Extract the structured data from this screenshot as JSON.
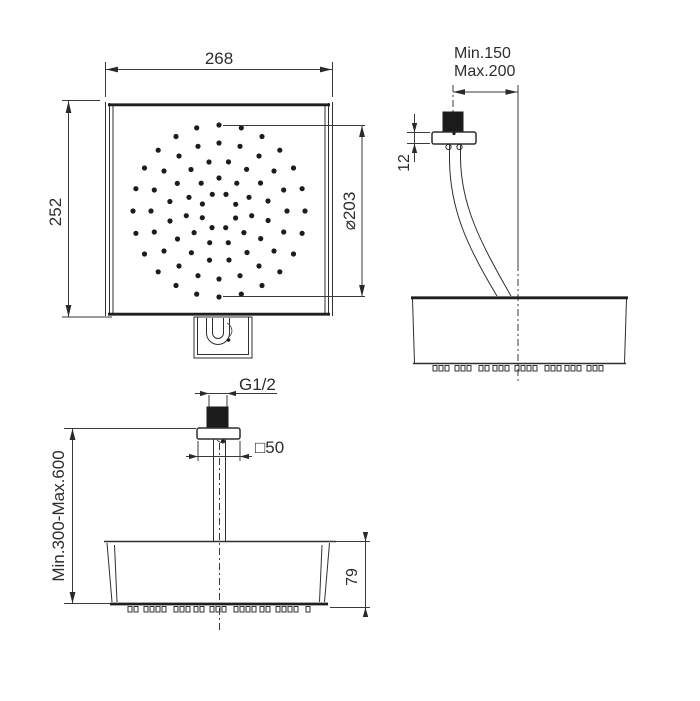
{
  "drawing": {
    "type": "technical-dimension-drawing",
    "subject": "square rain shower head, wall-arm and ceiling-arm installation views",
    "line_color": "#2f2f2f",
    "background": "#ffffff"
  },
  "dimensions": {
    "front_width": "268",
    "front_height": "252",
    "spray_diameter": "⌀203",
    "side_reach_min": "Min.150",
    "side_reach_max": "Max.200",
    "side_plate_thickness": "12",
    "ceiling_thread": "G1/2",
    "ceiling_plate_square": "□50",
    "ceiling_drop_range": "Min.300-Max.600",
    "ceiling_head_height": "79"
  },
  "spray_pattern": {
    "cx": 219,
    "cy": 211,
    "dot_r": 2.6,
    "rings": [
      {
        "r": 86,
        "n": 24,
        "a0": -90
      },
      {
        "r": 68,
        "n": 20,
        "a0": -90
      },
      {
        "r": 50,
        "n": 16,
        "a0": -79
      },
      {
        "r": 33,
        "n": 11,
        "a0": -90
      },
      {
        "r": 18,
        "n": 8,
        "a0": -67
      }
    ]
  },
  "nozzle_strips": [
    {
      "x0": 433,
      "x1": 607,
      "y": 365.5,
      "w": 4,
      "h": 5.5,
      "gaps": [
        2,
        2,
        6,
        2,
        2,
        8,
        2,
        4,
        2,
        2,
        6,
        2,
        2,
        2,
        8,
        2,
        2,
        4
      ]
    },
    {
      "x0": 128,
      "x1": 315,
      "y": 606.5,
      "w": 4,
      "h": 5.5,
      "gaps": [
        2,
        6,
        2,
        2,
        2,
        8,
        2,
        2,
        4,
        2,
        6,
        2,
        2,
        8,
        2,
        2,
        2,
        4
      ]
    }
  ]
}
